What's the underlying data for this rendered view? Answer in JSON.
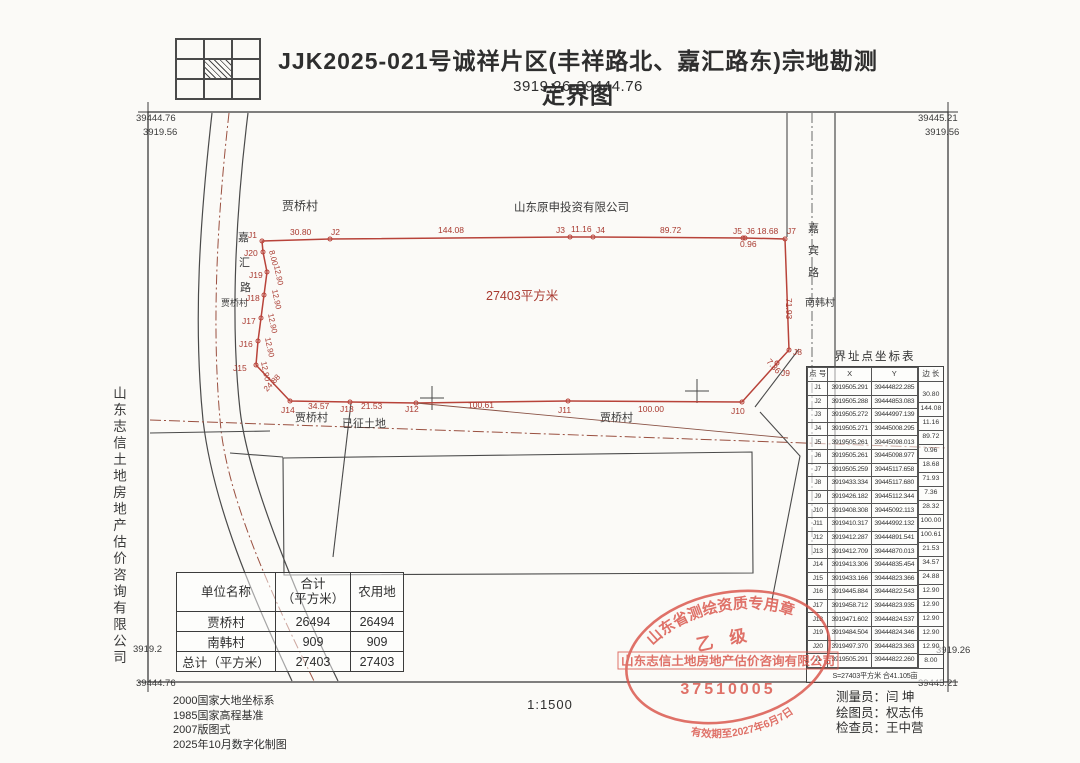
{
  "header": {
    "title": "JJK2025-021号诚祥片区(丰祥路北、嘉汇路东)宗地勘测定界图",
    "subtitle": "3919.26-39444.76"
  },
  "company_vertical": "山东志信土地房地产估价咨询有限公司",
  "colors": {
    "boundary_red": "#b8433a",
    "label_red": "#a93a30",
    "ink": "#3b3b3b",
    "stamp_red": "#d95349"
  },
  "map": {
    "labels": [
      {
        "t": "39444.76",
        "x": 136,
        "y": 121,
        "s": 9.5,
        "c": "#3b3b3b"
      },
      {
        "t": "3919.56",
        "x": 143,
        "y": 135,
        "s": 9.5,
        "c": "#3b3b3b"
      },
      {
        "t": "39445.21",
        "x": 918,
        "y": 121,
        "s": 9.5,
        "c": "#3b3b3b"
      },
      {
        "t": "3919.56",
        "x": 925,
        "y": 135,
        "s": 9.5,
        "c": "#3b3b3b"
      },
      {
        "t": "3919.2",
        "x": 133,
        "y": 652,
        "s": 9.5,
        "c": "#3b3b3b"
      },
      {
        "t": "39444.76",
        "x": 136,
        "y": 686,
        "s": 9.5,
        "c": "#3b3b3b"
      },
      {
        "t": "3919.26",
        "x": 936,
        "y": 653,
        "s": 9.5,
        "c": "#3b3b3b"
      },
      {
        "t": "39445.21",
        "x": 918,
        "y": 686,
        "s": 9.5,
        "c": "#3b3b3b"
      },
      {
        "t": "贾桥村",
        "x": 282,
        "y": 210,
        "s": 12,
        "c": "#3b3b3b"
      },
      {
        "t": "山东原申投资有限公司",
        "x": 514,
        "y": 211,
        "s": 11.5,
        "c": "#3b3b3b"
      },
      {
        "t": "嘉",
        "x": 238,
        "y": 241,
        "s": 11,
        "c": "#3b3b3b"
      },
      {
        "t": "汇",
        "x": 239,
        "y": 266,
        "s": 11,
        "c": "#3b3b3b"
      },
      {
        "t": "路",
        "x": 240,
        "y": 291,
        "s": 11,
        "c": "#3b3b3b"
      },
      {
        "t": "贾桥村",
        "x": 221,
        "y": 306,
        "s": 9,
        "c": "#3b3b3b"
      },
      {
        "t": "27403平方米",
        "x": 486,
        "y": 300,
        "s": 12.5,
        "c": "#a93a30"
      },
      {
        "t": "嘉",
        "x": 808,
        "y": 232,
        "s": 11,
        "c": "#3b3b3b"
      },
      {
        "t": "宾",
        "x": 808,
        "y": 254,
        "s": 11,
        "c": "#3b3b3b"
      },
      {
        "t": "路",
        "x": 808,
        "y": 276,
        "s": 11,
        "c": "#3b3b3b"
      },
      {
        "t": "南韩村",
        "x": 805,
        "y": 306,
        "s": 10,
        "c": "#3b3b3b"
      },
      {
        "t": "贾桥村",
        "x": 295,
        "y": 421,
        "s": 11,
        "c": "#3b3b3b"
      },
      {
        "t": "已征土地",
        "x": 342,
        "y": 427,
        "s": 11,
        "c": "#3b3b3b"
      },
      {
        "t": "贾桥村",
        "x": 600,
        "y": 421,
        "s": 11,
        "c": "#3b3b3b"
      },
      {
        "t": "J1",
        "x": 248,
        "y": 238,
        "s": 8.5,
        "c": "#a93a30"
      },
      {
        "t": "30.80",
        "x": 290,
        "y": 235,
        "s": 8.5,
        "c": "#a93a30"
      },
      {
        "t": "J2",
        "x": 331,
        "y": 235,
        "s": 8.5,
        "c": "#a93a30"
      },
      {
        "t": "144.08",
        "x": 438,
        "y": 233,
        "s": 8.5,
        "c": "#a93a30"
      },
      {
        "t": "J3",
        "x": 556,
        "y": 233,
        "s": 8.5,
        "c": "#a93a30"
      },
      {
        "t": "11.16",
        "x": 571,
        "y": 232,
        "s": 8.5,
        "c": "#a93a30"
      },
      {
        "t": "J4",
        "x": 596,
        "y": 233,
        "s": 8.5,
        "c": "#a93a30"
      },
      {
        "t": "89.72",
        "x": 660,
        "y": 233,
        "s": 8.5,
        "c": "#a93a30"
      },
      {
        "t": "J5",
        "x": 733,
        "y": 234,
        "s": 8.5,
        "c": "#a93a30"
      },
      {
        "t": "J6",
        "x": 746,
        "y": 234,
        "s": 8.5,
        "c": "#a93a30"
      },
      {
        "t": "18.68",
        "x": 757,
        "y": 234,
        "s": 8.5,
        "c": "#a93a30"
      },
      {
        "t": "J7",
        "x": 787,
        "y": 234,
        "s": 8.5,
        "c": "#a93a30"
      },
      {
        "t": "0.96",
        "x": 740,
        "y": 247,
        "s": 8.5,
        "c": "#a93a30"
      },
      {
        "t": "71.93",
        "x": 786,
        "y": 298,
        "s": 8.5,
        "c": "#a93a30",
        "r": 90
      },
      {
        "t": "J8",
        "x": 793,
        "y": 355,
        "s": 8.5,
        "c": "#a93a30"
      },
      {
        "t": "7.36",
        "x": 766,
        "y": 362,
        "s": 8.5,
        "c": "#a93a30",
        "r": 48
      },
      {
        "t": "J9",
        "x": 781,
        "y": 376,
        "s": 8.5,
        "c": "#a93a30"
      },
      {
        "t": "J10",
        "x": 731,
        "y": 414,
        "s": 8.5,
        "c": "#a93a30"
      },
      {
        "t": "100.00",
        "x": 638,
        "y": 412,
        "s": 8.5,
        "c": "#a93a30"
      },
      {
        "t": "J11",
        "x": 558,
        "y": 413,
        "s": 8.5,
        "c": "#a93a30"
      },
      {
        "t": "100.61",
        "x": 468,
        "y": 408,
        "s": 8.5,
        "c": "#a93a30"
      },
      {
        "t": "J12",
        "x": 405,
        "y": 412,
        "s": 8.5,
        "c": "#a93a30"
      },
      {
        "t": "21.53",
        "x": 361,
        "y": 409,
        "s": 8.5,
        "c": "#a93a30"
      },
      {
        "t": "J13",
        "x": 340,
        "y": 412,
        "s": 8.5,
        "c": "#a93a30"
      },
      {
        "t": "34.57",
        "x": 308,
        "y": 409,
        "s": 8.5,
        "c": "#a93a30"
      },
      {
        "t": "J14",
        "x": 281,
        "y": 413,
        "s": 8.5,
        "c": "#a93a30"
      },
      {
        "t": "8.00",
        "x": 269,
        "y": 251,
        "s": 8,
        "c": "#a93a30",
        "r": 76
      },
      {
        "t": "12.90",
        "x": 274,
        "y": 266,
        "s": 8,
        "c": "#a93a30",
        "r": 78
      },
      {
        "t": "12.90",
        "x": 272,
        "y": 290,
        "s": 8,
        "c": "#a93a30",
        "r": 78
      },
      {
        "t": "12.90",
        "x": 268,
        "y": 314,
        "s": 8,
        "c": "#a93a30",
        "r": 78
      },
      {
        "t": "12.90",
        "x": 265,
        "y": 338,
        "s": 8,
        "c": "#a93a30",
        "r": 78
      },
      {
        "t": "12.90",
        "x": 261,
        "y": 362,
        "s": 8,
        "c": "#a93a30",
        "r": 78
      },
      {
        "t": "24.88",
        "x": 267,
        "y": 392,
        "s": 8,
        "c": "#a93a30",
        "r": -47
      },
      {
        "t": "J20",
        "x": 244,
        "y": 256,
        "s": 8.5,
        "c": "#a93a30"
      },
      {
        "t": "J19",
        "x": 249,
        "y": 278,
        "s": 8.5,
        "c": "#a93a30"
      },
      {
        "t": "J18",
        "x": 246,
        "y": 301,
        "s": 8.5,
        "c": "#a93a30"
      },
      {
        "t": "J17",
        "x": 242,
        "y": 324,
        "s": 8.5,
        "c": "#a93a30"
      },
      {
        "t": "J16",
        "x": 239,
        "y": 347,
        "s": 8.5,
        "c": "#a93a30"
      },
      {
        "t": "J15",
        "x": 233,
        "y": 371,
        "s": 8.5,
        "c": "#a93a30"
      }
    ]
  },
  "coord_table": {
    "title": "界址点坐标表",
    "headers": [
      "点 号",
      "X",
      "Y",
      "边 长"
    ],
    "rows": [
      [
        "J1",
        "3919505.291",
        "39444822.285"
      ],
      [
        "J2",
        "3919505.288",
        "39444853.083"
      ],
      [
        "J3",
        "3919505.272",
        "39444997.139"
      ],
      [
        "J4",
        "3919505.271",
        "39445008.295"
      ],
      [
        "J5",
        "3919505.261",
        "39445098.013"
      ],
      [
        "J6",
        "3919505.261",
        "39445098.977"
      ],
      [
        "J7",
        "3919505.259",
        "39445117.658"
      ],
      [
        "J8",
        "3919433.334",
        "39445117.680"
      ],
      [
        "J9",
        "3919426.182",
        "39445112.344"
      ],
      [
        "J10",
        "3919408.308",
        "39445092.113"
      ],
      [
        "J11",
        "3919410.317",
        "39444992.132"
      ],
      [
        "J12",
        "3919412.287",
        "39444891.541"
      ],
      [
        "J13",
        "3919412.709",
        "39444870.013"
      ],
      [
        "J14",
        "3919413.306",
        "39444835.454"
      ],
      [
        "J15",
        "3919433.166",
        "39444823.366"
      ],
      [
        "J16",
        "3919445.884",
        "39444822.543"
      ],
      [
        "J17",
        "3919458.712",
        "39444823.935"
      ],
      [
        "J18",
        "3919471.602",
        "39444824.537"
      ],
      [
        "J19",
        "3919484.504",
        "39444824.346"
      ],
      [
        "J20",
        "3919497.370",
        "39444823.363"
      ],
      [
        "J1",
        "3919505.291",
        "39444822.260"
      ]
    ],
    "lengths": [
      "30.80",
      "144.08",
      "11.16",
      "89.72",
      "0.96",
      "18.68",
      "71.93",
      "7.36",
      "28.32",
      "100.00",
      "100.61",
      "21.53",
      "34.57",
      "24.88",
      "12.90",
      "12.90",
      "12.90",
      "12.90",
      "12.90",
      "8.00"
    ],
    "footer": "S=27403平方米  合41.105亩"
  },
  "unit_table": {
    "headers": [
      "单位名称",
      "合计\n（平方米）",
      "农用地"
    ],
    "rows": [
      [
        "贾桥村",
        "26494",
        "26494"
      ],
      [
        "南韩村",
        "909",
        "909"
      ],
      [
        "总计（平方米）",
        "27403",
        "27403"
      ]
    ]
  },
  "notes": [
    "2000国家大地坐标系",
    "1985国家高程基准",
    "2007版图式",
    "2025年10月数字化制图"
  ],
  "scale": "1:1500",
  "staff": [
    {
      "role": "测量员：",
      "name": "闫  坤"
    },
    {
      "role": "绘图员：",
      "name": "权志伟"
    },
    {
      "role": "检查员：",
      "name": "王中营"
    }
  ],
  "stamp": {
    "top": "山东省测绘资质专用章",
    "grade": "乙    级",
    "company": "山东志信土地房地产估价咨询有限公司",
    "number": "37510005",
    "validity": "有效期至2027年6月7日"
  }
}
